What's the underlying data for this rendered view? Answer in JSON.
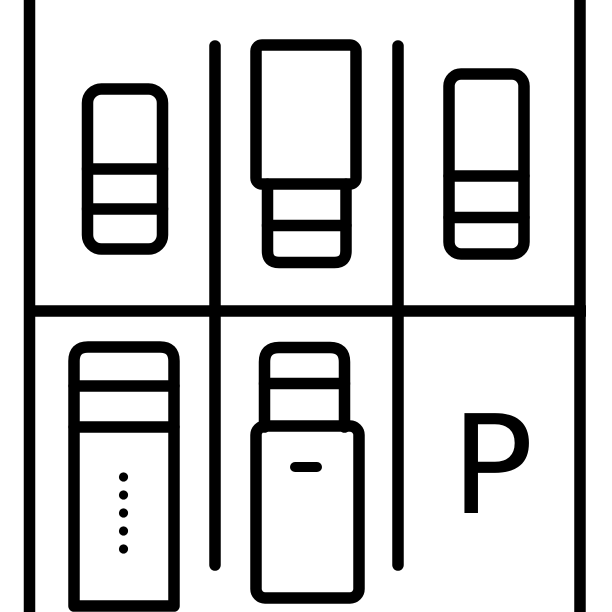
{
  "icon": {
    "name": "parking-lot-top-view",
    "description": "line-art icon of a parking lot seen from above with two rows of bays"
  },
  "colors": {
    "stroke": "#000000",
    "background": "#ffffff"
  },
  "sign": {
    "letter": "P"
  },
  "lot": {
    "rows": 2,
    "bays_per_row": 3,
    "occupied_bays": 5,
    "empty_marked_bays": 1,
    "vehicles": [
      {
        "position": "top-left",
        "type": "car"
      },
      {
        "position": "top-middle",
        "type": "truck"
      },
      {
        "position": "top-right",
        "type": "car"
      },
      {
        "position": "bottom-left",
        "type": "truck"
      },
      {
        "position": "bottom-middle",
        "type": "car"
      }
    ]
  }
}
